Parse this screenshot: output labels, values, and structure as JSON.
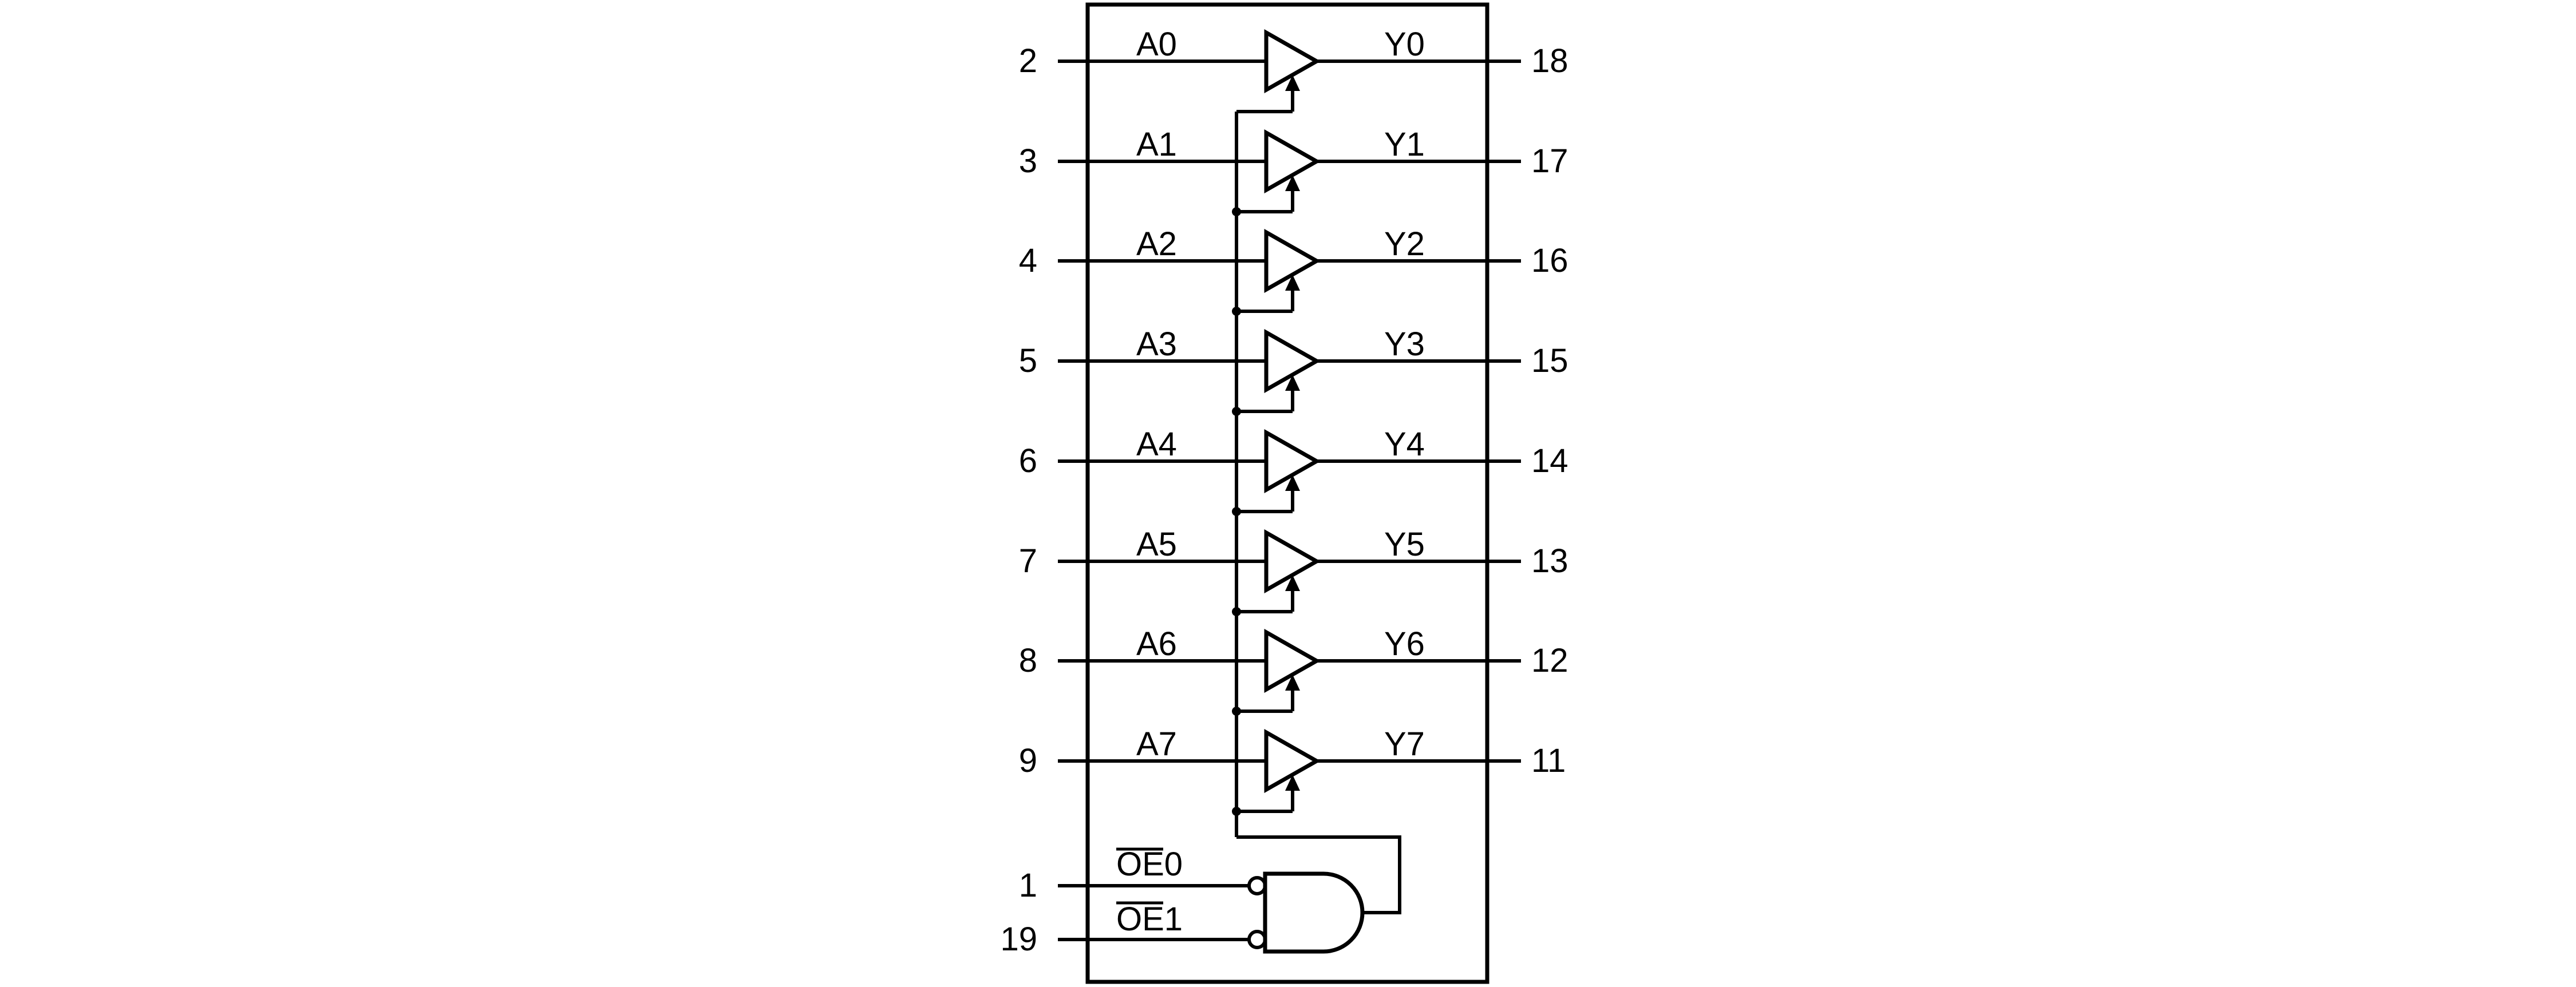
{
  "diagram": {
    "type": "logic-diagram-octal-buffer",
    "background_color": "#ffffff",
    "line_color": "#000000",
    "channels": [
      {
        "input_pin": "2",
        "input_label": "A0",
        "output_label": "Y0",
        "output_pin": "18"
      },
      {
        "input_pin": "3",
        "input_label": "A1",
        "output_label": "Y1",
        "output_pin": "17"
      },
      {
        "input_pin": "4",
        "input_label": "A2",
        "output_label": "Y2",
        "output_pin": "16"
      },
      {
        "input_pin": "5",
        "input_label": "A3",
        "output_label": "Y3",
        "output_pin": "15"
      },
      {
        "input_pin": "6",
        "input_label": "A4",
        "output_label": "Y4",
        "output_pin": "14"
      },
      {
        "input_pin": "7",
        "input_label": "A5",
        "output_label": "Y5",
        "output_pin": "13"
      },
      {
        "input_pin": "8",
        "input_label": "A6",
        "output_label": "Y6",
        "output_pin": "12"
      },
      {
        "input_pin": "9",
        "input_label": "A7",
        "output_label": "Y7",
        "output_pin": "11"
      }
    ],
    "enable_inputs": [
      {
        "pin": "1",
        "label": "OE0",
        "overline_over": "OE",
        "active_low": true
      },
      {
        "pin": "19",
        "label": "OE1",
        "overline_over": "OE",
        "active_low": true
      }
    ],
    "gate": {
      "type": "and-gate",
      "inverted_inputs": 2
    }
  }
}
